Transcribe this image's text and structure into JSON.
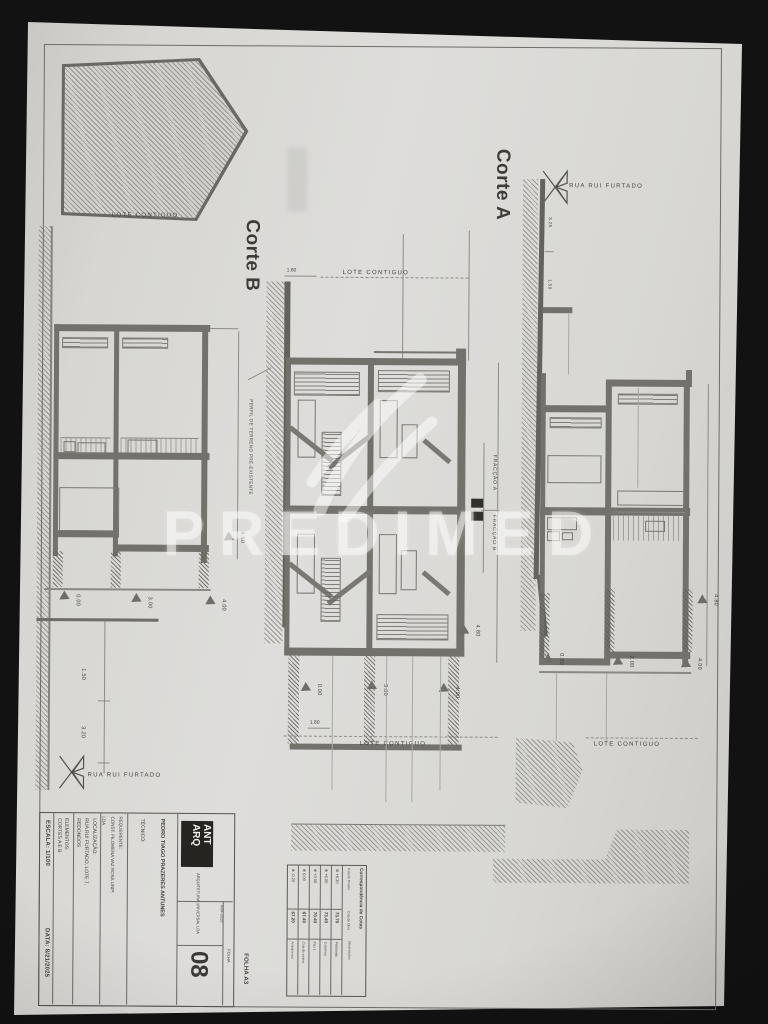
{
  "photo": {
    "watermark_text": "PREDIMED"
  },
  "sheet": {
    "sections": {
      "corte_c": {
        "title": "Corte C",
        "lote_contiguo": "LOTE CONTIGUO",
        "levels": [
          "0.00",
          "3.00",
          "4.00"
        ],
        "level_right": "4.80",
        "dim_lower_1": "1.50",
        "dim_lower_2": "3.20",
        "street": "RUA RUI FURTADO"
      },
      "corte_b": {
        "title": "Corte B",
        "dim_top": "1.80",
        "lote_contiguo_top": "LOTE CONTIGUO",
        "terrain_note": "PERFIL DE TERRENO PRÉ-EXISTENTE",
        "fraccao_a": "FRACÇÃO A",
        "fraccao_b": "FRACÇÃO B",
        "levels": [
          "0.00",
          "3.00",
          "4.00"
        ],
        "level_right": "4.80",
        "dim_bottom": "1.80",
        "lote_contiguo_bottom": "LOTE CONTIGUO"
      },
      "corte_a": {
        "title": "Corte A",
        "street": "RUA RUI FURTADO",
        "street_dim_1": "3.25",
        "street_dim_2": "1.50",
        "levels": [
          "0.00",
          "2.00",
          "4.00"
        ],
        "level_right": "4.80",
        "lote_contiguo": "LOTE CONTIGUO"
      }
    },
    "cotas_table": {
      "title": "Correspondência de Cotas",
      "col_cota": "Cota do Projeto",
      "col_valor": "Cota de Obra",
      "col_obs": "Observações",
      "rows": [
        {
          "cota": "-0.20",
          "valor": "67.20",
          "obs": "Arranjos ext."
        },
        {
          "cota": "0.00",
          "valor": "67.40",
          "obs": "Cota de soleira"
        },
        {
          "cota": "+3.00",
          "valor": "70.40",
          "obs": "Piso 1"
        },
        {
          "cota": "+6.00",
          "valor": "73.40",
          "obs": "Cobertura"
        },
        {
          "cota": "+6.30",
          "valor": "73.70",
          "obs": "Platibanda"
        }
      ]
    },
    "title_block": {
      "logo_line1": "ANT",
      "logo_line2": "ARQ",
      "logo_sub": "ARQUITETURA UNIVERSAL LDA",
      "tecnico_label": "TÉCNICO:",
      "tecnico": "PEDRO TIAGO PRAZERES ANTUNES",
      "requerente_label": "REQUERENTE:",
      "requerente_line1": "CONST. FILOMENA VAZ ROSA UNIP.",
      "requerente_line2": "LDA",
      "localizacao_label": "LOCALIZAÇÃO:",
      "localizacao_line1": "RUA RUI FURTADO, LOTE 7,",
      "localizacao_line2": "REDONDOS",
      "elementos_label": "ELEMENTOS:",
      "elementos": "CORTES A E B",
      "escala": "ESCALA: 1/100",
      "data": "DATA: 8/21/2025",
      "processo": "A39-2025",
      "folha_label": "FOLHA",
      "folha_numero": "08",
      "folha_formato": "FOLHA A3"
    }
  }
}
